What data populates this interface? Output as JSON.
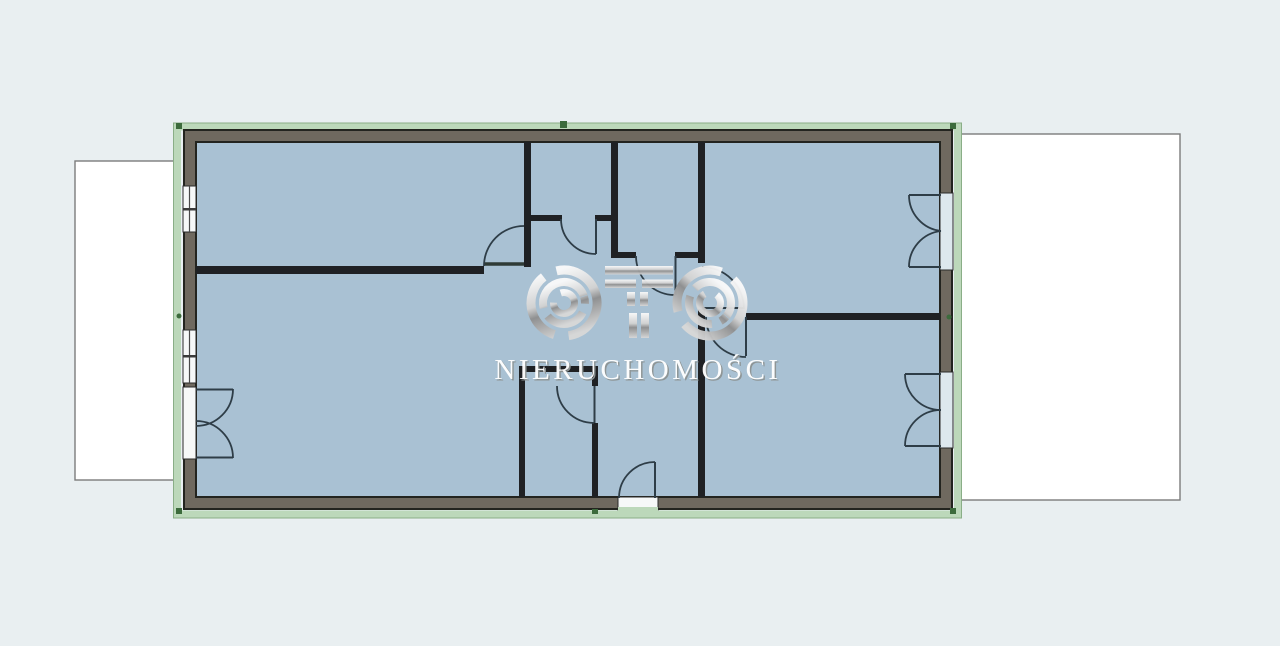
{
  "watermark": {
    "logo_text": "OTO",
    "subtitle": "NIERUCHOMOŚCI"
  },
  "colors": {
    "background": "#e9eff1",
    "floor": "#a9c1d3",
    "outer_wall": "#6f695f",
    "wall_edge": "#23241f",
    "interior_wall": "#1f2124",
    "green_outline": "#bcd8ba",
    "green_mark": "#3c6b3c",
    "terrace_fill": "#ffffff",
    "terrace_border": "#7c7c7c",
    "door_line": "#2e3d47",
    "window_fill": "#f6f8f8",
    "watermark_silver_light": "#fafafa",
    "watermark_silver_dark": "#8f8f8f",
    "watermark_text": "#ffffff"
  }
}
